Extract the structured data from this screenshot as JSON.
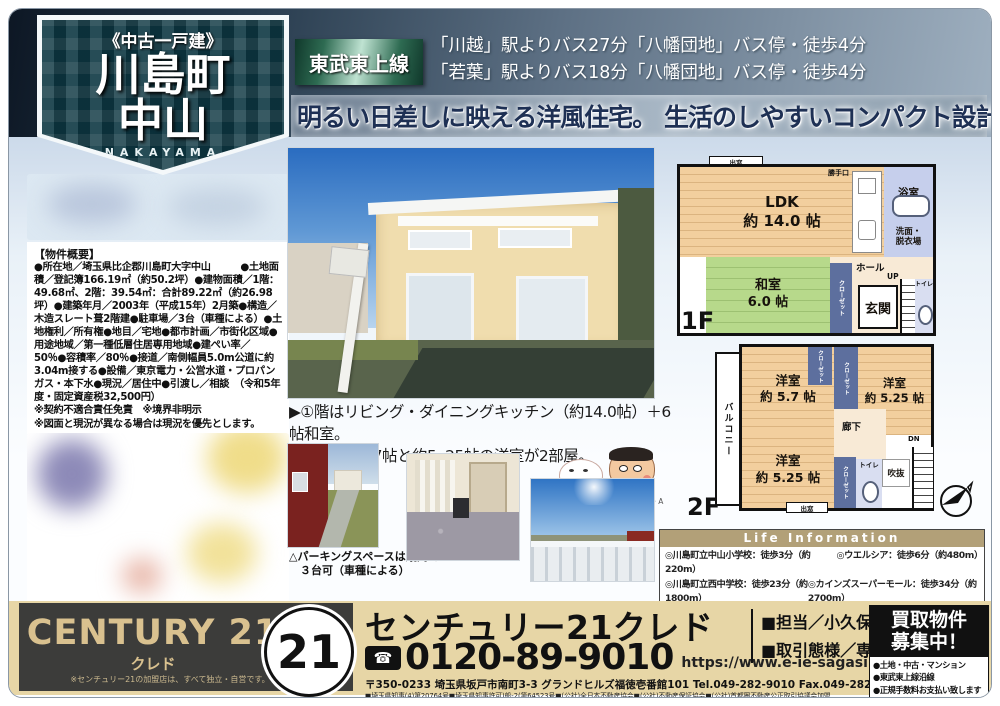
{
  "badge": {
    "category": "《中古一戸建》",
    "title_line1": "川島町",
    "title_line2": "中山",
    "romaji": "NAKAYAMA"
  },
  "header": {
    "train_line": "東武東上線",
    "access_line1": "「川越」駅よりバス27分「八幡団地」バス停・徒歩4分",
    "access_line2": "「若葉」駅よりバス18分「八幡団地」バス停・徒歩4分",
    "catchphrase": "明るい日差しに映える洋風住宅。 生活のしやすいコンパクト設計。"
  },
  "overview": {
    "title": "【物件概要】",
    "body": "●所在地／埼玉県比企郡川島町大字中山　　　●土地面積／登記簿166.19㎡（約50.2坪）●建物面積／1階：49.68㎡、2階：39.54㎡：合計89.22㎡（約26.98坪）●建築年月／2003年（平成15年）2月築●構造／木造スレート葺2階建●駐車場／3台（車種による）●土地権利／所有権●地目／宅地●都市計画／市街化区域●用途地域／第一種低層住居専用地域●建ぺい率／50％●容積率／80％●接道／南側幅員5.0m公道に約3.04m接する●設備／東京電力・公営水道・プロパンガス・本下水●現況／居住中●引渡し／相談　（令和5年度・固定資産税32,500円）",
    "note1": "※契約不適合責任免責　※境界非明示",
    "note2": "※図面と現況が異なる場合は現況を優先とします。"
  },
  "features": {
    "line1": "▶①階はリビング・ダイニングキッチン（約14.0帖）＋6帖和室。",
    "line2": "▶②階は約5.7帖と約5. 25帖の洋室が2部屋。"
  },
  "photos": {
    "parking_caption": "△パーキングスペースは縦列で\n　３台可（車種による）",
    "copyright": "©U／F・S・A・A"
  },
  "floorplan": {
    "f1": {
      "label": "1F",
      "ldk": "LDK\n約 14.0 帖",
      "washitsu": "和室\n6.0 帖",
      "bath": "浴室",
      "wash": "洗面・\n脱衣場",
      "hall": "ホール",
      "genkan": "玄関",
      "toilet": "トイレ",
      "up": "UP",
      "closet": "クローゼット",
      "kitchen_door": "勝手口",
      "bay_window": "出窓"
    },
    "f2": {
      "label": "2F",
      "room1": "洋室\n約 5.7 帖",
      "room2": "洋室\n約 5.25 帖",
      "room3": "洋室\n約 5.25 帖",
      "balcony": "バルコニー",
      "closet": "クローゼット",
      "hallway": "廊下",
      "toilet": "トイレ",
      "void": "吹抜",
      "dn": "DN",
      "bay_window": "出窓"
    }
  },
  "life_info": {
    "title": "Life  Information",
    "items": [
      "◎川島町立中山小学校：徒歩3分（約220m）",
      "◎ウエルシア：徒歩6分（約480m）",
      "◎川島町立西中学校：徒歩23分（約1800m）",
      "◎カインズスーパーモール：徒歩34分（約2700m）",
      "◎セブンイレブン：徒歩5分（約400m）",
      "◎ヤオコー（クリニング店・セリア・さいしんキャッシュコーナー）：徒歩2分（約120m）"
    ]
  },
  "footer": {
    "century_logo": "CENTURY 21",
    "century_sub": "クレド",
    "century_disclaimer": "※センチュリー21の加盟店は、すべて独立・自営です。",
    "seal": "21",
    "company": "センチュリー21クレド",
    "freedial_icon": "☎",
    "phone": "0120-89-9010",
    "url": "https://www.e-ie-sagasi.com",
    "address": "〒350-0233 埼玉県坂戸市南町3-3 グランドヒルズ福徳壱番館101 Tel.049-282-9010 Fax.049-282-9009",
    "license": "■埼玉県知事(4)第20764号■埼玉県知事許可)般-2(第64523号■(公社)全日本不動産協会■(公社)不動産保証協会■(公社)首都圏不動産公正取引協議会加盟",
    "staff": "■担当／小久保（コクボ）",
    "deal_type": "■取引態様／専任媒介",
    "kaitori_title": "買取物件\n募集中！",
    "kaitori_item1": "●土地・中古・マンション",
    "kaitori_item2": "●東武東上線沿線",
    "kaitori_item3": "●正規手数料お支払い致します"
  },
  "colors": {
    "accent_teal": "#0b3540",
    "tobu_green": "#2e6b52",
    "tan_band": "#e7d6a6",
    "life_header": "#b2a078",
    "catch_navy": "#1e3054"
  }
}
